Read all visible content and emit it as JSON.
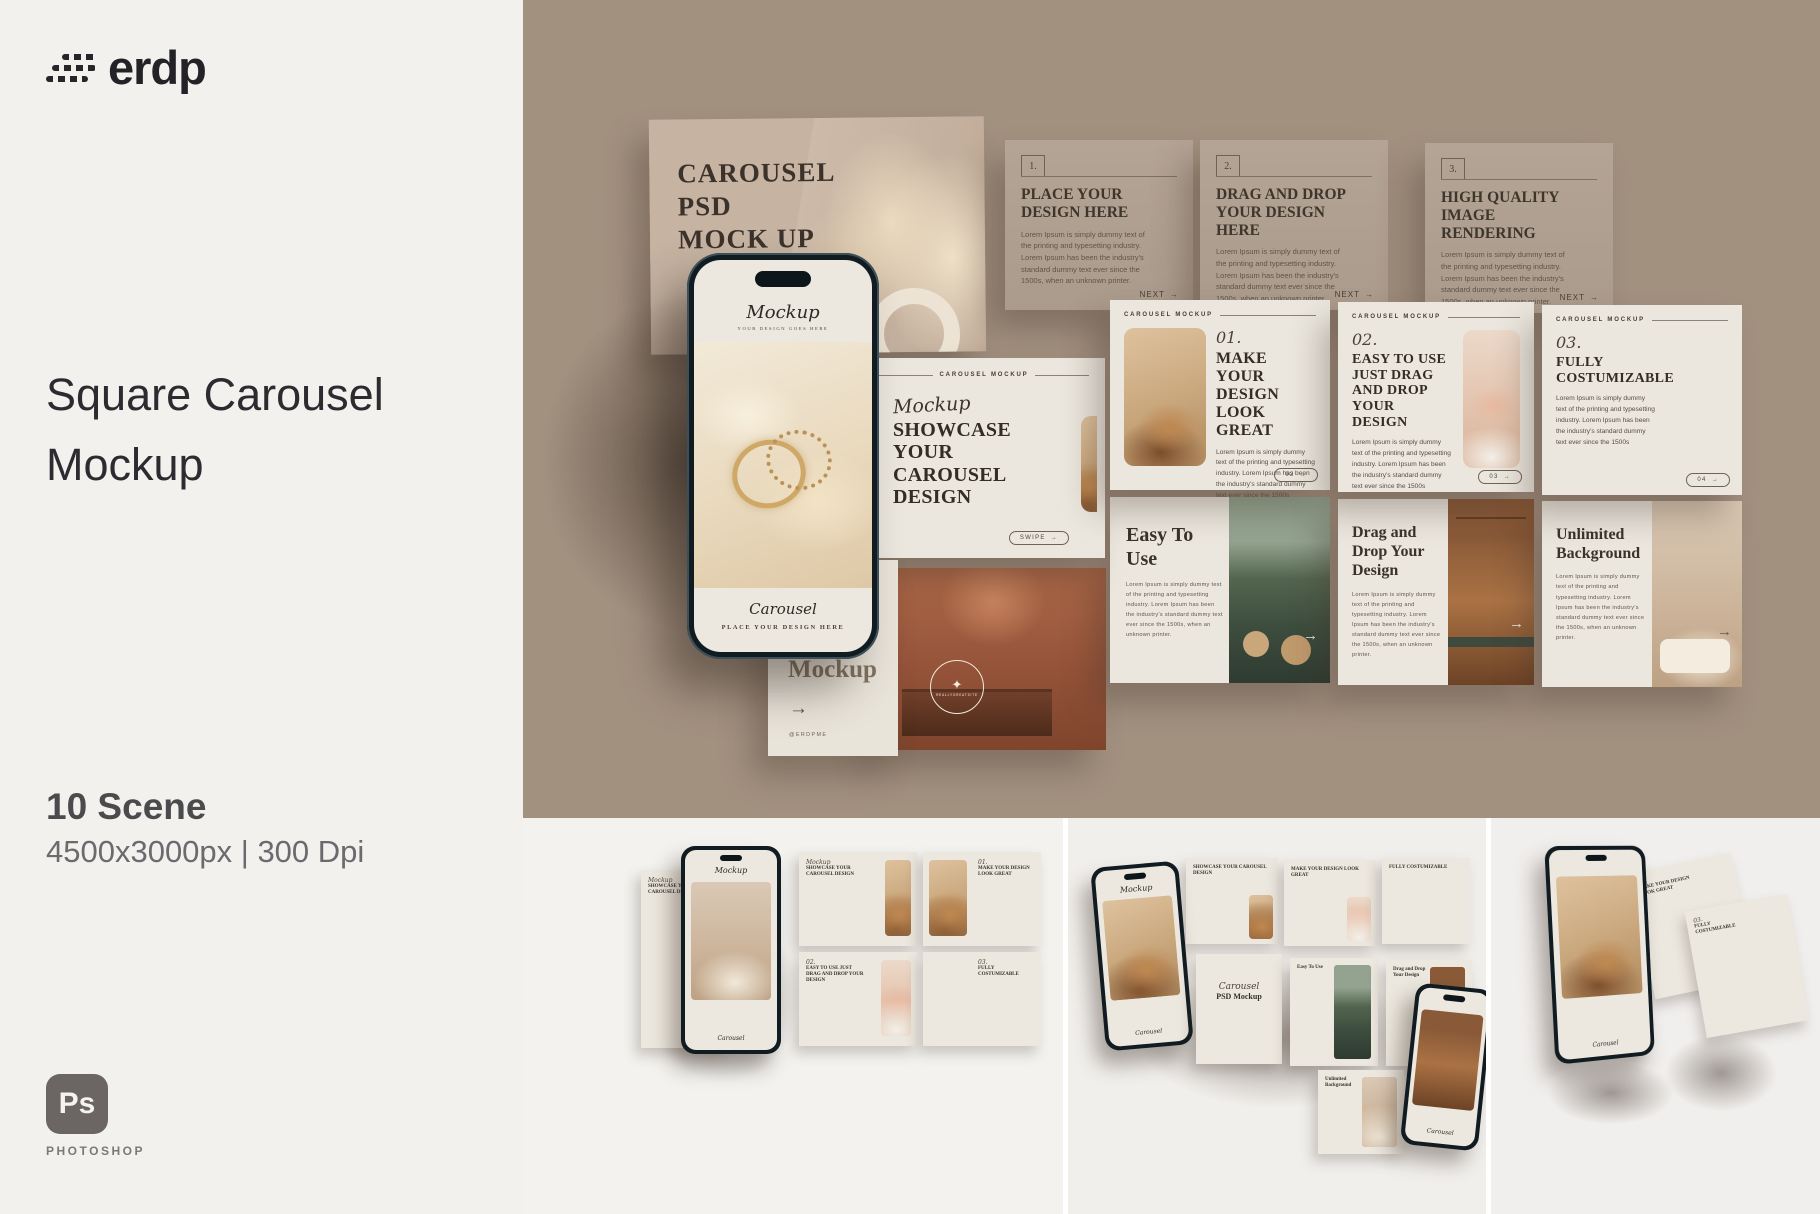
{
  "icons": {
    "arrow_right": "→",
    "star": "✦"
  },
  "colors": {
    "taupe_bg": "#a39180",
    "panel_bg": "#f2f1ee",
    "card_taupe": "#b4a496",
    "card_cream": "#ebe7de",
    "ink": "#2c2b30",
    "ps_gray": "#6b6663"
  },
  "left_panel": {
    "brand": "erdp",
    "title_line1": "Square Carousel",
    "title_line2": "Mockup",
    "scene_count": "10 Scene",
    "specs": "4500x3000px | 300 Dpi",
    "ps_badge": "Ps",
    "ps_label": "PHOTOSHOP"
  },
  "scene": {
    "cover_card": {
      "title": "CAROUSEL PSD MOCK UP"
    },
    "top_cards": [
      {
        "num": "1.",
        "title": "PLACE YOUR DESIGN HERE",
        "body": "Lorem Ipsum is simply dummy text of the printing and typesetting industry. Lorem Ipsum has been the industry's standard dummy text ever since the 1500s, when an unknown printer.",
        "next": "NEXT"
      },
      {
        "num": "2.",
        "title": "DRAG AND DROP YOUR DESIGN HERE",
        "body": "Lorem Ipsum is simply dummy text of the printing and typesetting industry. Lorem Ipsum has been the industry's standard dummy text ever since the 1500s, when an unknown printer.",
        "next": "NEXT"
      },
      {
        "num": "3.",
        "title": "HIGH QUALITY IMAGE RENDERING",
        "body": "Lorem Ipsum is simply dummy text of the printing and typesetting industry. Lorem Ipsum has been the industry's standard dummy text ever since the 1500s, when an unknown printer.",
        "next": "NEXT"
      }
    ],
    "mid_cards": [
      {
        "header": "CAROUSEL MOCKUP",
        "script": "Mockup",
        "title": "SHOWCASE YOUR CAROUSEL DESIGN",
        "pill": "SWIPE"
      },
      {
        "header": "CAROUSEL MOCKUP",
        "num": "01.",
        "title": "MAKE YOUR DESIGN LOOK GREAT",
        "body": "Lorem Ipsum is simply dummy text of the printing and typesetting industry. Lorem Ipsum has been the industry's standard dummy text ever since the 1500s",
        "pill": "02"
      },
      {
        "header": "CAROUSEL MOCKUP",
        "num": "02.",
        "title": "EASY TO USE JUST DRAG AND DROP YOUR DESIGN",
        "body": "Lorem Ipsum is simply dummy text of the printing and typesetting industry. Lorem Ipsum has been the industry's standard dummy text ever since the 1500s",
        "pill": "03"
      },
      {
        "header": "CAROUSEL MOCKUP",
        "num": "03.",
        "title": "FULLY COSTUMIZABLE",
        "body": "Lorem Ipsum is simply dummy text of the printing and typesetting industry. Lorem Ipsum has been the industry's standard dummy text ever since the 1500s",
        "pill": "04"
      }
    ],
    "bottom_cards": [
      {
        "badge": "REALLYGREATSITE"
      },
      {
        "title": "Easy To Use",
        "body": "Lorem Ipsum is simply dummy text of the printing and typesetting industry. Lorem Ipsum has been the industry's standard dummy text ever since the 1500s, when an unknown printer."
      },
      {
        "title": "Drag and Drop Your Design",
        "body": "Lorem Ipsum is simply dummy text of the printing and typesetting industry. Lorem Ipsum has been the industry's standard dummy text ever since the 1500s, when an unknown printer."
      },
      {
        "title": "Unlimited Background",
        "body": "Lorem Ipsum is simply dummy text of the printing and typesetting industry. Lorem Ipsum has been the industry's standard dummy text ever since the 1500s, when an unknown printer."
      }
    ],
    "phone": {
      "script": "Mockup",
      "subtitle": "YOUR DESIGN GOES HERE",
      "caption_script": "Carousel",
      "caption": "PLACE YOUR DESIGN HERE"
    },
    "outro_card": {
      "title": "Mockup",
      "handle": "@ERDPME"
    }
  },
  "thumbnails": {
    "scene1": {
      "phone_script": "Mockup",
      "phone_caption": "Carousel",
      "cards": [
        {
          "num": "",
          "script": "Mockup",
          "title": "SHOWCASE YOUR CAROUSEL DESIGN"
        },
        {
          "num": "01.",
          "script": "",
          "title": "MAKE YOUR DESIGN LOOK GREAT"
        },
        {
          "num": "02.",
          "script": "",
          "title": "EASY TO USE JUST DRAG AND DROP YOUR DESIGN"
        },
        {
          "num": "03.",
          "script": "",
          "title": "FULLY COSTUMIZABLE"
        }
      ]
    },
    "scene2": {
      "center_script": "Carousel",
      "center_title": "PSD Mockup",
      "back_cards": [
        "SHOWCASE YOUR CAROUSEL DESIGN",
        "MAKE YOUR DESIGN LOOK GREAT",
        "EASY TO USE JUST DRAG AND DROP YOUR DESIGN",
        "FULLY COSTUMIZABLE"
      ],
      "front_cards": [
        "Easy To Use",
        "Drag and Drop Your Design",
        "Unlimited Background"
      ],
      "phone_script": "Mockup"
    },
    "scene3": {
      "phone_caption": "Carousel",
      "cards": [
        "MAKE YOUR DESIGN LOOK GREAT",
        "FULLY COSTUMIZABLE"
      ]
    }
  }
}
